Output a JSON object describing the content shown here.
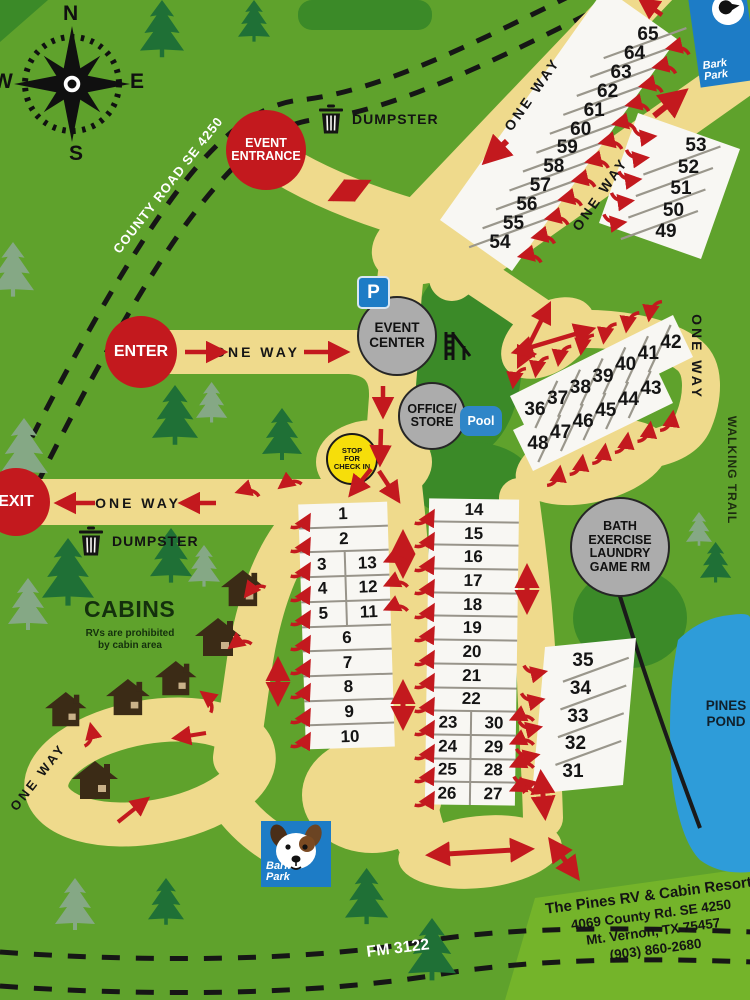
{
  "compass": {
    "n": "N",
    "e": "E",
    "s": "S",
    "w": "W"
  },
  "roads": {
    "county_road": "COUNTY ROAD SE 4250",
    "fm_road": "FM 3122",
    "walking_trail": "WALKING TRAIL",
    "one_way": "ONE WAY"
  },
  "markers": {
    "enter": "ENTER",
    "exit": "EXIT",
    "event_entrance": [
      "EVENT",
      "ENTRANCE"
    ],
    "event_center": [
      "EVENT",
      "CENTER"
    ],
    "office_store": [
      "OFFICE/",
      "STORE"
    ],
    "stop_check_in": [
      "STOP",
      "FOR",
      "CHECK IN"
    ],
    "bath_house": [
      "BATH",
      "EXERCISE",
      "LAUNDRY",
      "GAME RM"
    ],
    "pool": "Pool",
    "parking": "P",
    "dumpster_top": "DUMPSTER",
    "dumpster_cabins": "DUMPSTER",
    "pines_pond": [
      "PINES",
      "POND"
    ],
    "bark_park": [
      "Bark",
      "Park"
    ]
  },
  "cabins": {
    "title": "CABINS",
    "note": [
      "RVs are prohibited",
      "by cabin area"
    ]
  },
  "sites": {
    "column_1_13": [
      [
        "1"
      ],
      [
        "2"
      ],
      [
        "3",
        "13"
      ],
      [
        "4",
        "12"
      ],
      [
        "5",
        "11"
      ],
      [
        "6"
      ],
      [
        "7"
      ],
      [
        "8"
      ],
      [
        "9"
      ],
      [
        "10"
      ]
    ],
    "column_14_30": [
      [
        "14"
      ],
      [
        "15"
      ],
      [
        "16"
      ],
      [
        "17"
      ],
      [
        "18"
      ],
      [
        "19"
      ],
      [
        "20"
      ],
      [
        "21"
      ],
      [
        "22"
      ],
      [
        "23",
        "30"
      ],
      [
        "24",
        "29"
      ],
      [
        "25",
        "28"
      ],
      [
        "26",
        "27"
      ]
    ],
    "row_54_65": [
      "54",
      "55",
      "56",
      "57",
      "58",
      "59",
      "60",
      "61",
      "62",
      "63",
      "64",
      "65"
    ],
    "row_49_53": [
      "49",
      "50",
      "51",
      "52",
      "53"
    ],
    "row_36_42": [
      "36",
      "37",
      "38",
      "39",
      "40",
      "41",
      "42"
    ],
    "row_43_48": [
      "48",
      "47",
      "46",
      "45",
      "44",
      "43"
    ],
    "row_31_35": [
      "35",
      "34",
      "33",
      "32",
      "31"
    ]
  },
  "address": {
    "name": "The Pines RV & Cabin Resort",
    "street": "4069 County Rd. SE 4250",
    "city": "Mt. Vernon, TX 75457",
    "phone": "(903) 860-2680"
  },
  "colors": {
    "map_green": "#5FA22C",
    "dark_green": "#3B8A28",
    "road_tan": "#EFDA8C",
    "arrow_red": "#C3191E",
    "circle_gray": "#ACACAC",
    "checkin_yellow": "#F6DE0A",
    "sign_blue": "#1D7CC6",
    "pond_blue": "#2E9CD9"
  }
}
